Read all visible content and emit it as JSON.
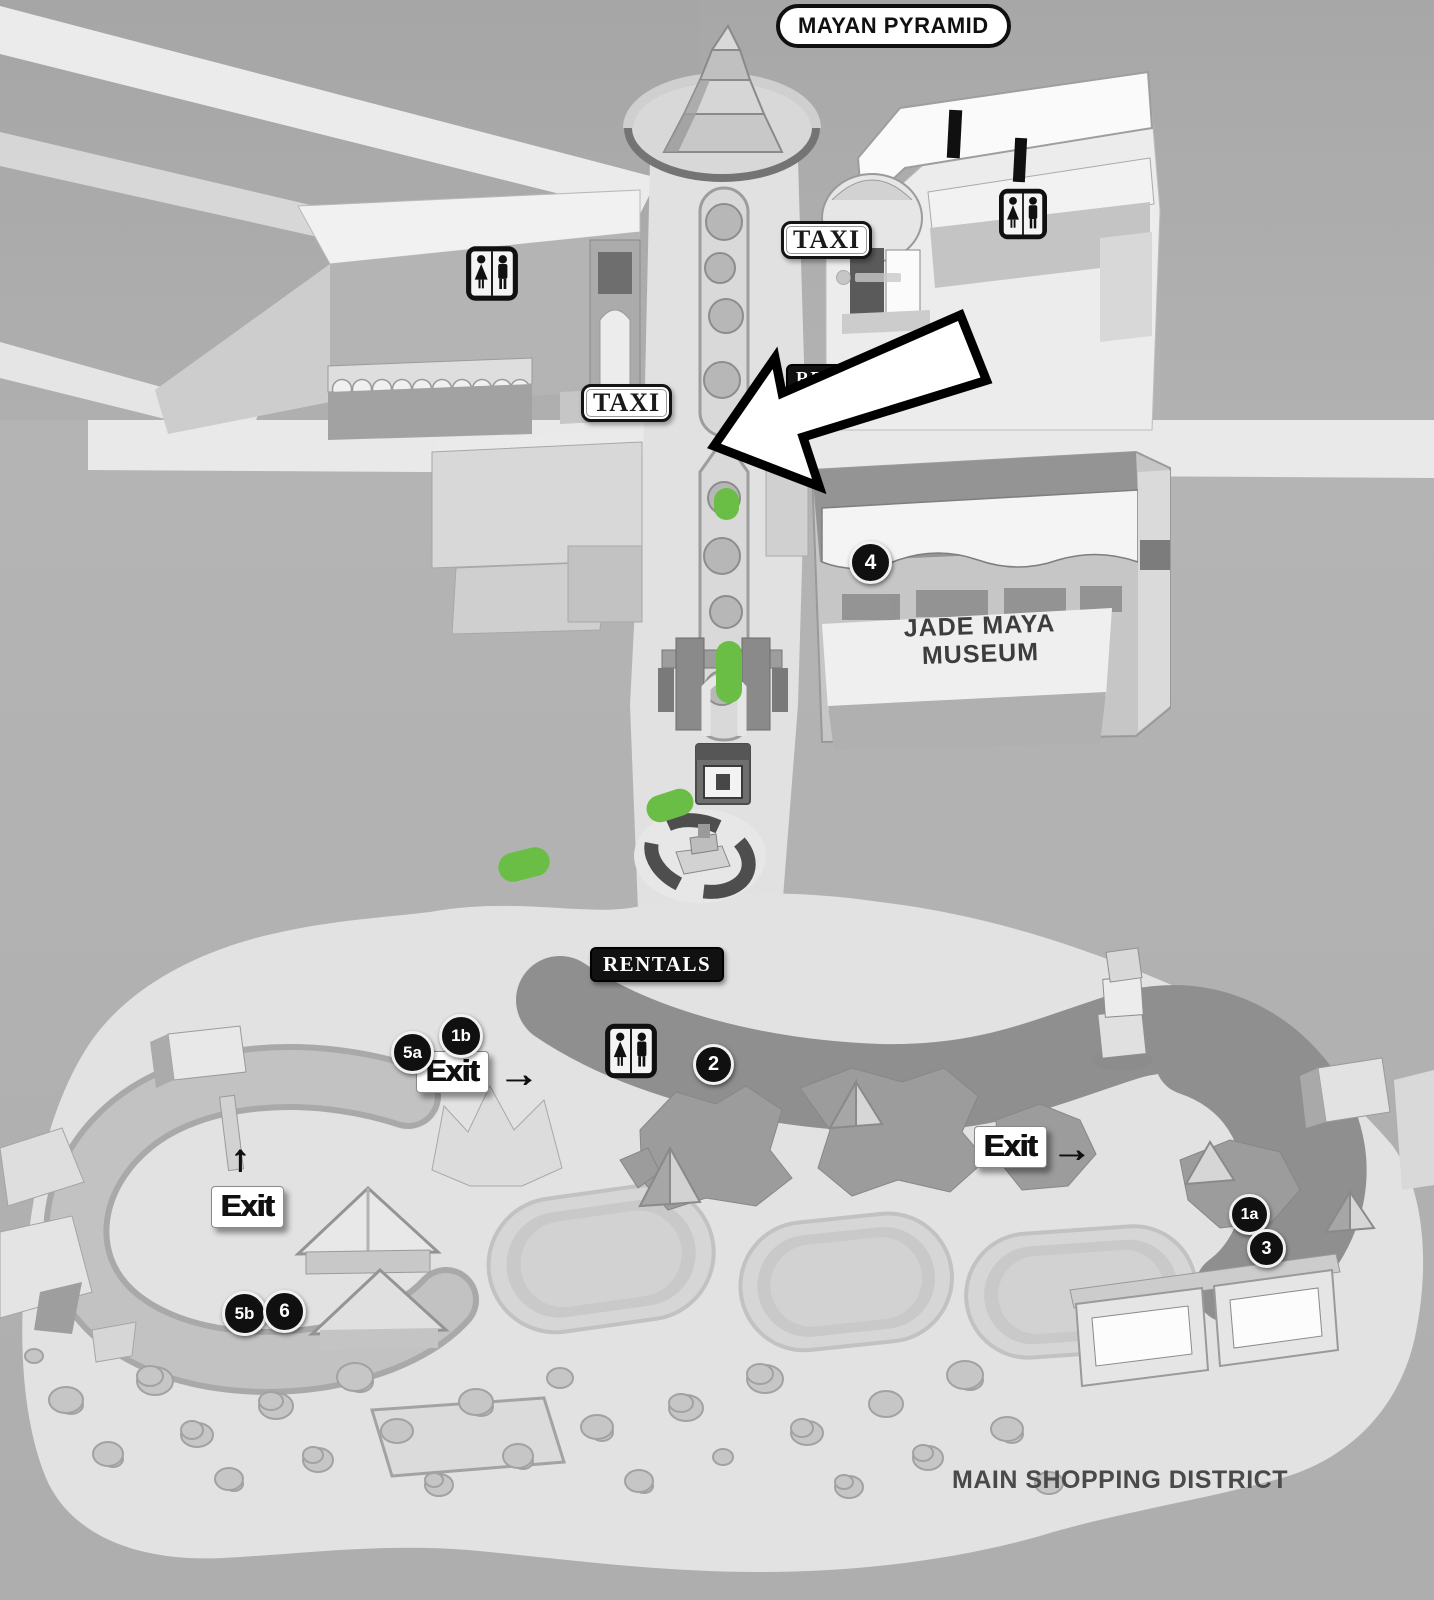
{
  "map": {
    "title": "MAYAN PYRAMID",
    "district_label": "MAIN SHOPPING DISTRICT",
    "museum": {
      "line1": "JADE MAYA",
      "line2": "MUSEUM"
    },
    "signs": {
      "taxi_north": "TAXI",
      "taxi_west": "TAXI",
      "rentals_north": "RENTALS",
      "rentals_south": "RENTALS"
    },
    "exits": {
      "north": {
        "label": "Exit",
        "arrow": "→"
      },
      "west": {
        "label": "Exit",
        "arrow": "↑"
      },
      "east": {
        "label": "Exit",
        "arrow": "→"
      }
    },
    "markers": [
      {
        "label": "4"
      },
      {
        "label": "2"
      },
      {
        "label": "5a"
      },
      {
        "label": "1b"
      },
      {
        "label": "1a"
      },
      {
        "label": "3"
      },
      {
        "label": "5b"
      },
      {
        "label": "6"
      }
    ],
    "icons": {
      "restroom_count": 3,
      "direction_arrow": "large-white-arrow"
    },
    "route": {
      "color": "#6abe45",
      "dash_count": 4
    }
  }
}
